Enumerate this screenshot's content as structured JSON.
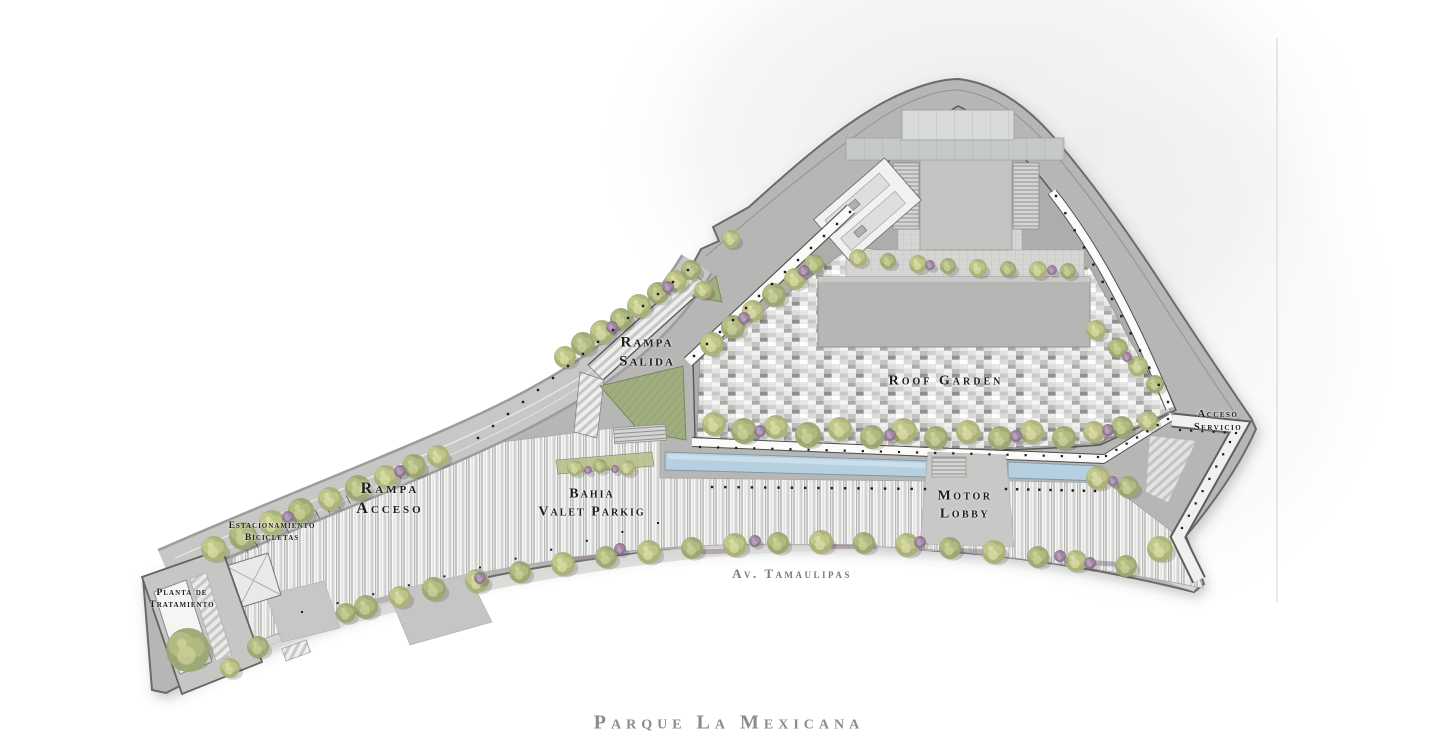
{
  "plan": {
    "title": "Parque La Mexicana",
    "street": {
      "name": "Av. Tamaulipas"
    },
    "labels": {
      "rampa_salida": {
        "line1": "Rampa",
        "line2": "Salida"
      },
      "roof_garden": {
        "line1": "Roof Garden"
      },
      "acceso_servicio": {
        "line1": "Acceso",
        "line2": "Servicio"
      },
      "rampa_acceso": {
        "line1": "Rampa",
        "line2": "Acceso"
      },
      "bahia_valet": {
        "line1": "Bahia",
        "line2": "Valet Parkig"
      },
      "motor_lobby": {
        "line1": "Motor",
        "line2": "Lobby"
      },
      "estacionamiento": {
        "line1": "Estacionamiento",
        "line2": "Bicicletas"
      },
      "planta": {
        "line1": "Planta de",
        "line2": "Tratamiento"
      }
    },
    "colors": {
      "label_ink": "#1c1c1a",
      "street_gray": "#7b7b79",
      "title_gray": "#8b8b89",
      "pool_water": "#b7d0e0",
      "lawn_green": "#a0ad7e",
      "foliage_olive": "#9aa671",
      "foliage_sage": "#aab177",
      "foliage_purple": "#8d7390"
    }
  }
}
